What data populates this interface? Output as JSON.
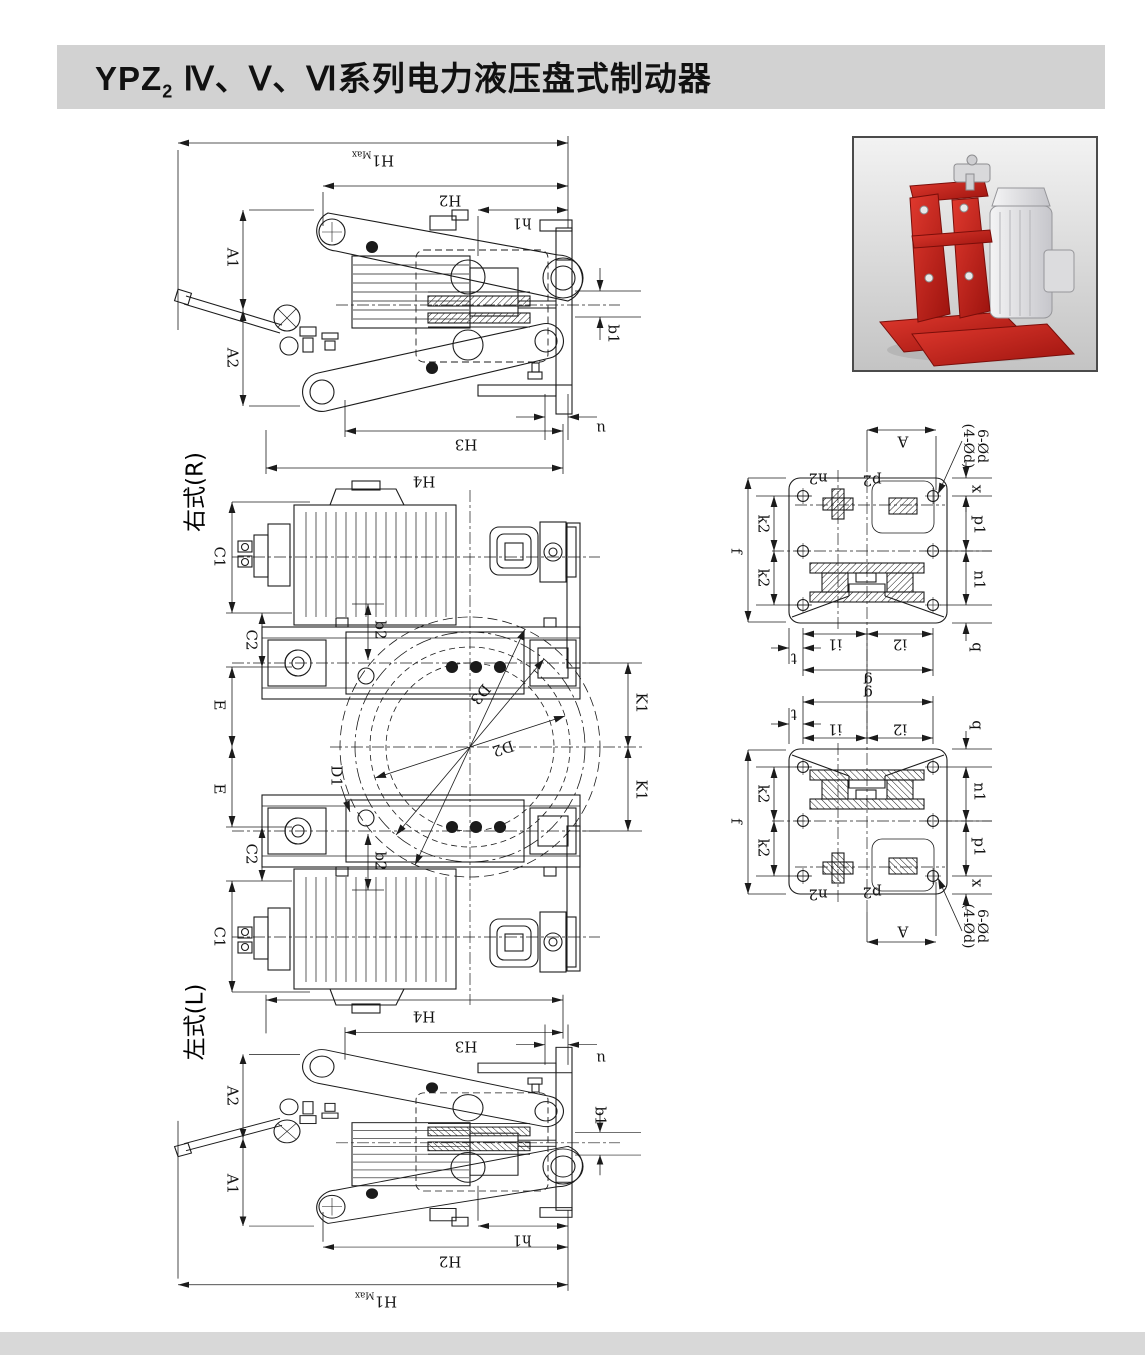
{
  "title": {
    "brand": "YPZ",
    "sub": "2",
    "series": " Ⅳ、Ⅴ、Ⅵ系列电力液压盘式制动器"
  },
  "views": {
    "right": "右式(R)",
    "left": "左式(L)"
  },
  "dims": {
    "h1": "H1",
    "h1sub": "Max",
    "h2": "H2",
    "h1l": "h1",
    "a1": "A1",
    "a2": "A2",
    "b1": "b1",
    "u": "u",
    "h3": "H3",
    "h4": "H4",
    "c1": "C1",
    "c2": "C2",
    "e": "E",
    "b2": "b2",
    "k1": "K1",
    "d1": "D1",
    "d2": "D2",
    "d3": "D3"
  },
  "plate_dims": {
    "a": "A",
    "n1": "n1",
    "n2": "n2",
    "p1": "p1",
    "p2": "p2",
    "x": "x",
    "k2": "k2",
    "f": "f",
    "q": "q",
    "t": "t",
    "i1": "i1",
    "i2": "i2",
    "g": "g",
    "holes_primary": "6-Ød",
    "holes_alt": "(4-Ød)"
  },
  "colors": {
    "banner_bg": "#d2d2d2",
    "line": "#1b1b1b",
    "photo_red": "#c1241f",
    "photo_silver": "#e6e6e8",
    "page_bottom_strip": "#d8d8d8"
  }
}
